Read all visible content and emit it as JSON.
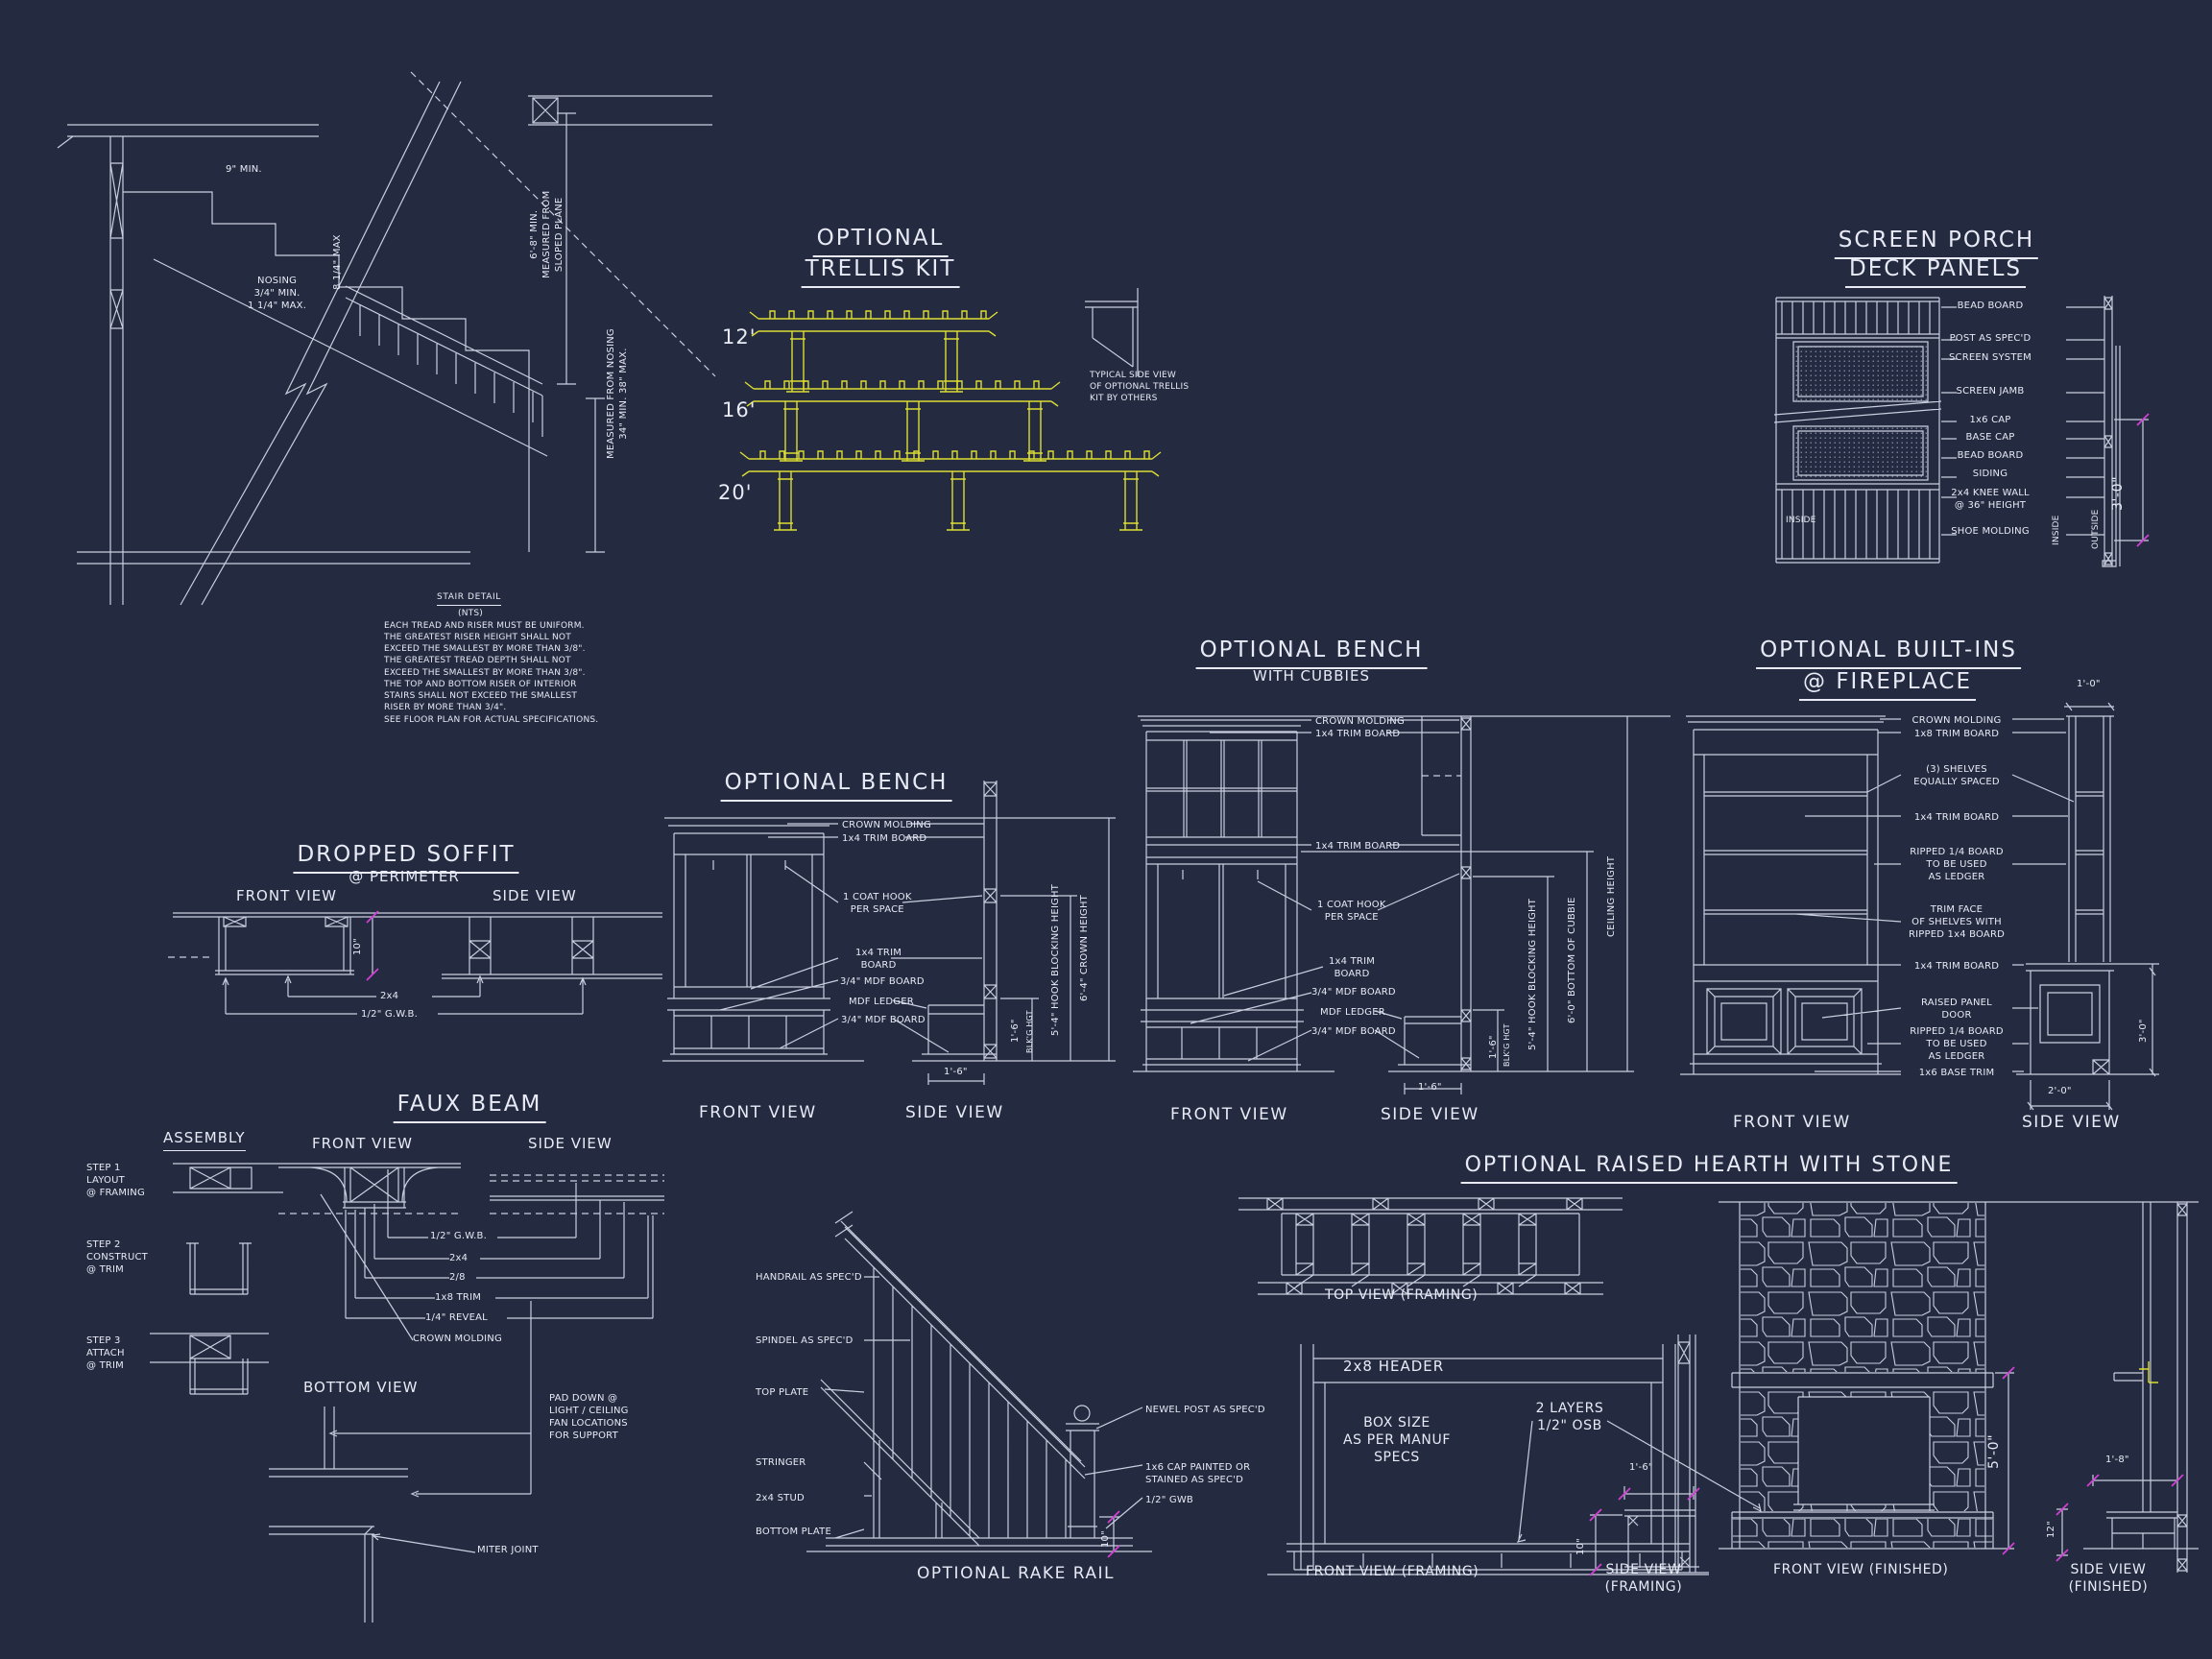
{
  "sheet": {
    "background": "#242a40",
    "line_color": "#c9cfdf",
    "text_color": "#e8ebf5",
    "accent_yellow": "#dddd33",
    "accent_magenta": "#d23fd2"
  },
  "stair": {
    "title": "STAIR DETAIL",
    "nts": "(NTS)",
    "tread_dim": "9\" MIN.",
    "riser_dim": "8 1/4\" MAX",
    "nosing": "NOSING\n3/4\" MIN.\n1 1/4\" MAX.",
    "headroom": "6'-8\" MIN.\nMEASURED FROM\nSLOPED PLANE",
    "rail_height": "MEASURED FROM NOSING\n34\" MIN.  38\" MAX.",
    "notes": "EACH TREAD AND RISER MUST BE UNIFORM.\nTHE GREATEST RISER HEIGHT SHALL NOT\nEXCEED THE SMALLEST BY MORE THAN 3/8\".\nTHE GREATEST TREAD DEPTH SHALL NOT\nEXCEED THE SMALLEST BY MORE THAN 3/8\".\nTHE TOP AND BOTTOM RISER OF INTERIOR\nSTAIRS SHALL NOT EXCEED THE SMALLEST\nRISER BY MORE THAN 3/4\".",
    "see_note": "SEE FLOOR PLAN FOR ACTUAL SPECIFICATIONS."
  },
  "trellis": {
    "title1": "OPTIONAL",
    "title2": "TRELLIS KIT",
    "sizes": [
      "12'",
      "16'",
      "20'"
    ],
    "side_note": "TYPICAL SIDE VIEW\nOF OPTIONAL TRELLIS\nKIT BY OTHERS"
  },
  "screen_porch": {
    "title1": "SCREEN PORCH",
    "title2": "DECK PANELS",
    "labels": [
      "BEAD BOARD",
      "POST AS SPEC'D",
      "SCREEN SYSTEM",
      "SCREEN JAMB",
      "1x6 CAP",
      "BASE CAP",
      "BEAD BOARD",
      "SIDING",
      "2x4 KNEE WALL\n@ 36\" HEIGHT",
      "SHOE MOLDING"
    ],
    "inside_left": "INSIDE",
    "inside_right": "INSIDE",
    "outside": "OUTSIDE",
    "height_dim": "3'-0\""
  },
  "bench": {
    "title": "OPTIONAL BENCH",
    "labels": [
      "CROWN MOLDING",
      "1x4 TRIM BOARD",
      "1 COAT HOOK\nPER SPACE",
      "1x4 TRIM\nBOARD",
      "3/4\" MDF BOARD",
      "MDF LEDGER",
      "3/4\" MDF BOARD"
    ],
    "dim_blocking": "1'-6\"",
    "dim_blocking_sub": "BLK'G HGT",
    "dim_hook": "5'-4\" HOOK BLOCKING HEIGHT",
    "dim_crown": "6'-4\" CROWN HEIGHT",
    "dim_depth": "1'-6\"",
    "front_view": "FRONT VIEW",
    "side_view": "SIDE VIEW"
  },
  "bench_cubbies": {
    "title1": "OPTIONAL BENCH",
    "title2": "WITH CUBBIES",
    "labels": [
      "CROWN MOLDING",
      "1x4 TRIM BOARD",
      "1x4 TRIM BOARD",
      "1 COAT HOOK\nPER SPACE",
      "1x4 TRIM\nBOARD",
      "3/4\" MDF BOARD",
      "MDF LEDGER",
      "3/4\" MDF BOARD"
    ],
    "dim_blocking": "1'-6\"",
    "dim_blocking_sub": "BLK'G HGT",
    "dim_hook": "5'-4\" HOOK BLOCKING HEIGHT",
    "dim_cubbie": "6'-0\" BOTTOM OF CUBBIE",
    "dim_ceiling": "CEILING HEIGHT",
    "dim_depth": "1'-6\"",
    "front_view": "FRONT VIEW",
    "side_view": "SIDE VIEW"
  },
  "built_ins": {
    "title1": "OPTIONAL BUILT-INS",
    "title2": "@ FIREPLACE",
    "labels": [
      "CROWN MOLDING",
      "1x8 TRIM BOARD",
      "(3) SHELVES\nEQUALLY SPACED",
      "1x4 TRIM BOARD",
      "RIPPED 1/4 BOARD\nTO BE USED\nAS LEDGER",
      "TRIM FACE\nOF SHELVES WITH\nRIPPED 1x4 BOARD",
      "1x4 TRIM BOARD",
      "RAISED PANEL\nDOOR",
      "RIPPED 1/4 BOARD\nTO BE USED\nAS LEDGER",
      "1x6 BASE TRIM"
    ],
    "dim_top": "1'-0\"",
    "dim_height": "3'-0\"",
    "dim_depth": "2'-0\"",
    "front_view": "FRONT VIEW",
    "side_view": "SIDE VIEW"
  },
  "soffit": {
    "title1": "DROPPED SOFFIT",
    "title2": "@ PERIMETER",
    "front_view": "FRONT VIEW",
    "side_view": "SIDE VIEW",
    "dim": "10\"",
    "label_2x4": "2x4",
    "label_gwb": "1/2\" G.W.B."
  },
  "faux_beam": {
    "title": "FAUX BEAM",
    "assembly": "ASSEMBLY",
    "steps": [
      "STEP 1\nLAYOUT\n@ FRAMING",
      "STEP 2\nCONSTRUCT\n@ TRIM",
      "STEP 3\nATTACH\n@ TRIM"
    ],
    "front_view": "FRONT VIEW",
    "side_view": "SIDE VIEW",
    "bottom_view": "BOTTOM VIEW",
    "labels": [
      "1/2\" G.W.B.",
      "2x4",
      "2/8",
      "1x8 TRIM",
      "1/4\" REVEAL",
      "CROWN MOLDING"
    ],
    "pad_note": "PAD DOWN @\nLIGHT / CEILING\nFAN LOCATIONS\nFOR SUPPORT",
    "miter": "MITER JOINT"
  },
  "rake_rail": {
    "labels_left": [
      "HANDRAIL AS SPEC'D",
      "SPINDEL AS SPEC'D",
      "TOP PLATE",
      "STRINGER",
      "2x4 STUD",
      "BOTTOM PLATE"
    ],
    "labels_right": [
      "NEWEL POST AS SPEC'D",
      "1x6 CAP PAINTED OR\nSTAINED AS SPEC'D",
      "1/2\" GWB"
    ],
    "dim": "10\"",
    "title": "OPTIONAL RAKE RAIL"
  },
  "hearth": {
    "title": "OPTIONAL RAISED HEARTH WITH STONE",
    "top_view": "TOP VIEW (FRAMING)",
    "header": "2x8 HEADER",
    "box_note": "BOX SIZE\nAS PER MANUF\nSPECS",
    "osb_note": "2 LAYERS\n1/2\" OSB",
    "dim_bench_depth": "1'-6\"",
    "dim_bench_height": "10\"",
    "front_framing": "FRONT VIEW (FRAMING)",
    "side_framing": "SIDE VIEW\n(FRAMING)",
    "dim_height": "5'-0\"",
    "front_finished": "FRONT VIEW (FINISHED)",
    "dim_depth": "1'-8\"",
    "dim_hearth": "12\"",
    "side_finished": "SIDE VIEW\n(FINISHED)"
  }
}
